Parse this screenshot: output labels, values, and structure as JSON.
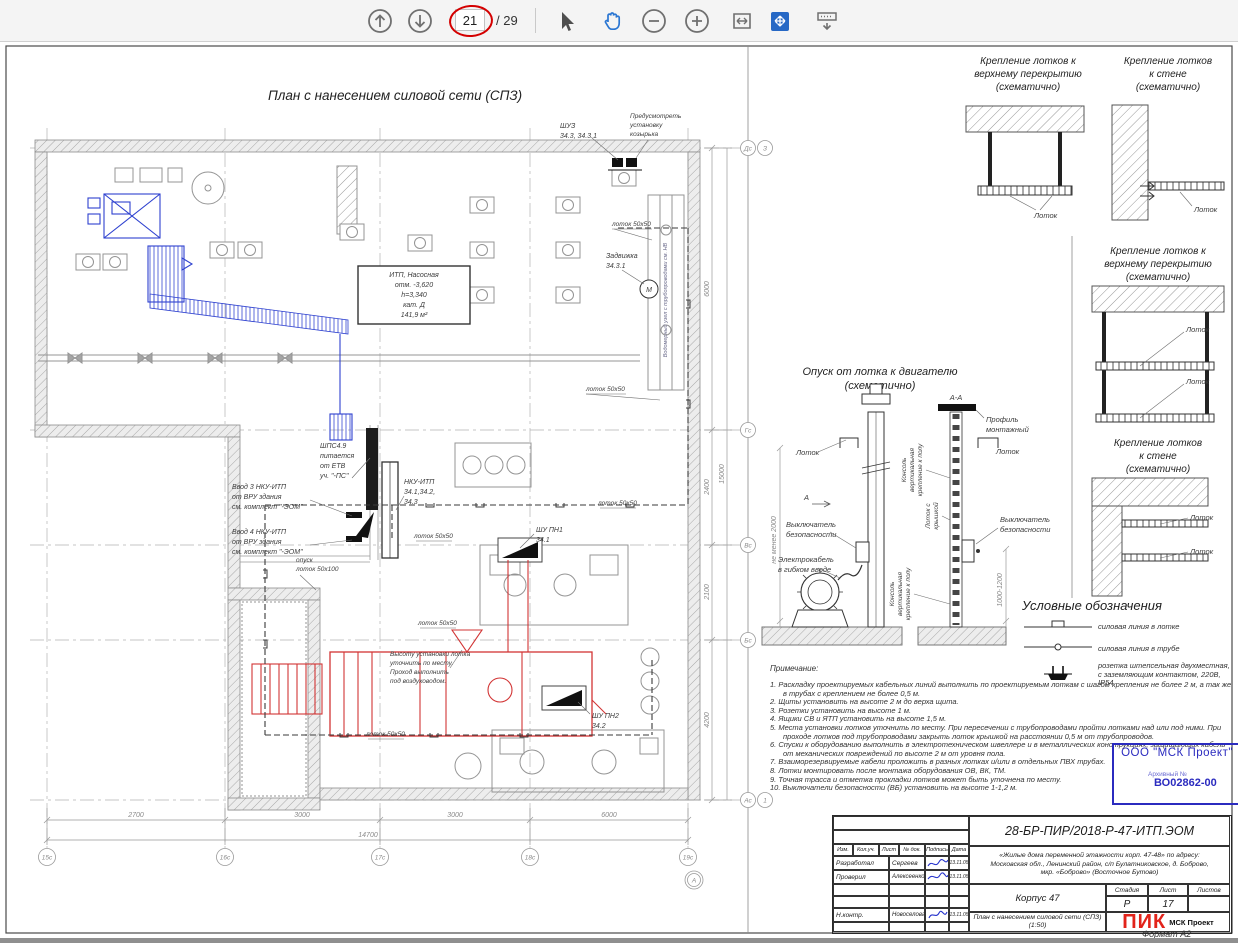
{
  "toolbar": {
    "page_current": "21",
    "page_total_label": "/ 29"
  },
  "plan": {
    "title": "План с нанесением силовой сети (СПЗ)",
    "itp_room": [
      "ИТП, Насосная",
      "отм. -3,620",
      "h=3,340",
      "кат. Д",
      "141,9 м²"
    ],
    "shuz": [
      "ШУЗ",
      "34.3, 34.3.1"
    ],
    "kozyrek": [
      "Предусмотреть",
      "установку",
      "козырька"
    ],
    "zadvizhka": [
      "Задвижка",
      "34.3.1"
    ],
    "lotok_50x50": "лоток 50х50",
    "opusk_lotok": [
      "опуск",
      "лоток 50х100"
    ],
    "shps": [
      "ШПС4.9",
      "питается",
      "от ЕТВ",
      "уч. \"-ПС\""
    ],
    "vvod3": [
      "Ввод 3 НКУ-ИТП",
      "от ВРУ здания",
      "см. комплект \"-ЭОМ\""
    ],
    "vvod4": [
      "Ввод 4 НКУ-ИТП",
      "от ВРУ здания",
      "см. комплект \"-ЭОМ\""
    ],
    "nku": [
      "НКУ-ИТП",
      "34.1,34.2,",
      "34.3"
    ],
    "shu_pn1": [
      "ШУ ПН1",
      "34.1"
    ],
    "shu_pn2": [
      "ШУ ПН2",
      "34.2"
    ],
    "vysota_note": [
      "Высоту установки лотка",
      "уточнить по месту.",
      "Проход выполнить",
      "под воздуховодом."
    ],
    "motor": "М",
    "wall_note": "Водомерный узел с трубопроводами см. НВ",
    "dims_bottom": [
      "2700",
      "3000",
      "3000",
      "6000"
    ],
    "dim_bottom_total": "14700",
    "dims_right": [
      "6000",
      "2400",
      "2100",
      "4200"
    ],
    "dim_right_total": "15000",
    "grid_bottom": [
      "15с",
      "16с",
      "17с",
      "18с",
      "19с"
    ],
    "grid_bottom_extra": "А",
    "grid_right": [
      "Дс",
      "Гс",
      "Вс",
      "Бс",
      "Ас"
    ],
    "grid_right_top_extra": "З",
    "grid_right_bottom_extra": "1"
  },
  "details": {
    "ceiling_title": [
      "Крепление лотков к",
      "верхнему перекрытию",
      "(схематично)"
    ],
    "wall_title": [
      "Крепление лотков",
      "к стене",
      "(схематично)"
    ],
    "lotok": "Лоток",
    "opusk": {
      "title": [
        "Опуск от лотка к двигателю",
        "(схематично)"
      ],
      "section": "А-А",
      "profil": [
        "Профиль",
        "монтажный"
      ],
      "lotok": "Лоток",
      "lotok_kryshka": [
        "Лоток с",
        "крышкой"
      ],
      "konsol": [
        "Консоль",
        "вертикальная",
        "крепление к полу"
      ],
      "vb": [
        "Выключатель",
        "безопасности"
      ],
      "kabel": [
        "Электрокабель",
        "в гибком вводе"
      ],
      "dim_height": "не менее 2000",
      "dim_vb": "1000-1200",
      "marker": "А"
    }
  },
  "legend": {
    "title": "Условные обозначения",
    "items": [
      "силовая линия в лотке",
      "силовая линия в трубе",
      "розетка штепсельная двухместная, с заземляющим контактом, 220В, IP54"
    ]
  },
  "notes": {
    "heading": "Примечание:",
    "items": [
      "1. Раскладку проектируемых кабельных линий выполнить по проектируемым лоткам с шагом крепления не более 2 м, а так же в трубах с креплением не более 0,5 м.",
      "2. Щиты установить на высоте 2 м до верха щита.",
      "3. Розетки установить на высоте 1 м.",
      "4. Ящики СВ и ЯТП установить на высоте 1,5 м.",
      "5. Места установки лотков уточнить по месту. При пересечении с трубопроводами пройти лотками над или под ними. При проходе лотков под трубопроводами закрыть лоток крышкой на расстоянии 0,5 м от трубопроводов.",
      "6. Спуски к оборудованию выполнить в электротехническом швеллере и в металлических конструкциях, защищающих кабель от механических повреждений по высоте 2 м от уровня пола.",
      "7. Взаиморезервируемые кабели проложить в разных лотках и/или в отдельных ПВХ трубах.",
      "8. Лотки монтировать после монтажа оборудования ОВ, ВК, ТМ.",
      "9. Точная трасса и отметка прокладки лотков может быть уточнена по месту.",
      "10. Выключатели безопасности (ВБ) установить на высоте 1-1,2 м."
    ]
  },
  "stamp": {
    "company": "ООО \"МСК Проект\"",
    "archive_label": "Архивный №",
    "archive_number": "ВО02862-00"
  },
  "titleblock": {
    "code": "28-БР-ПИР/2018-Р-47-ИТП.ЭОМ",
    "project": [
      "«Жилые дома переменной этажности корп. 47-48» по адресу:",
      "Московская обл., Ленинский район, с/п Булатниковское, д. Боброво,",
      "мкр. «Боброво» (Восточное Бутово)"
    ],
    "object_name": "Корпус 47",
    "drawing_name": [
      "План с нанесением силовой сети (СПЗ)",
      "(1:50)"
    ],
    "columns": [
      "Изм.",
      "Кол.уч.",
      "Лист",
      "№ док.",
      "Подпись",
      "Дата"
    ],
    "rows": [
      {
        "role": "Разработал",
        "name": "Сергеев",
        "date": "13.11.05"
      },
      {
        "role": "Проверил",
        "name": "Алексеенко",
        "date": "13.11.05"
      },
      {
        "role": "Н.контр.",
        "name": "Новоселова",
        "date": "13.11.05"
      }
    ],
    "stage_headers": [
      "Стадия",
      "Лист",
      "Листов"
    ],
    "stage": "Р",
    "sheet_number": "17",
    "sheets_total": "",
    "logo_primary": "ПИК",
    "logo_secondary": "МСК Проект"
  },
  "footer": {
    "format_label": "Формат А2"
  }
}
